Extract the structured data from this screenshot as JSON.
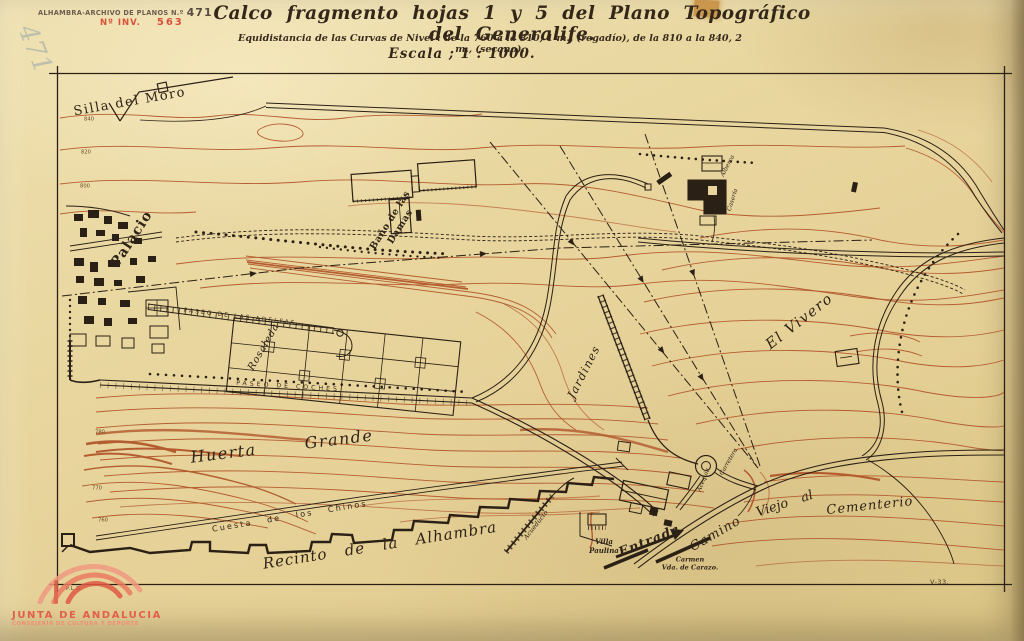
{
  "archive": {
    "stamp_prefix": "ALHAMBRA-ARCHIVO DE PLANOS N.º",
    "stamp_number": "471",
    "inv_label": "Nº INV.",
    "inv_number": "563",
    "pencil_number": "471"
  },
  "title": {
    "main": "Calco fragmento hojas 1 y 5 del Plano Topográfico del Generalife.",
    "subtitle": "Equidistancia de las Curvas de Nivel : de la 760 a la 810, 1 m., (regadío), de la 810 a la 840, 2 m., (secano).",
    "scale": "Escala ; 1 : 1000."
  },
  "map_labels": {
    "silla_del_moro": "Silla del Moro",
    "palacio": "Palacio",
    "bano_de_las": "Baño de las",
    "damas": "Damas",
    "paseo_adelfas": "Paseo de las Adelfas",
    "rosaleda": "Rosaleda",
    "paseo_coches": "Paseo de Coches",
    "huerta_grande": "Huerta  Grande",
    "jardines": "Jardines",
    "el_vivero": "El Vivero",
    "alberca": "Alberca",
    "caseria": "Casería",
    "cuesta_chinos": "Cuesta  de  los  Chinos",
    "recinto_alhambra": "Recinto  de  la  Alhambra",
    "acueducto": "Acueducto",
    "acequia": "Acequia",
    "carretera": "Carretera",
    "villa": "Villa",
    "paulina": "Paulina",
    "entrada": "Entrada",
    "carmen": "Carmen",
    "vda_carazo": "Vda. de Carazo.",
    "camino": "Camino",
    "viejo_al": "Viejo  al",
    "cementerio": "Cementerio"
  },
  "contour_labels": [
    "840",
    "820",
    "800",
    "780",
    "770",
    "760"
  ],
  "footer": {
    "corner_left": "P.L.D.",
    "plate_mark": "V-33."
  },
  "logo": {
    "line1": "JUNTA DE ANDALUCIA",
    "line2": "CONSEJERÍA DE CULTURA Y DEPORTE"
  },
  "colors": {
    "paper": "#e9d7a0",
    "contour_ink": "#b2572b",
    "drawing_ink": "#2b2015",
    "stamp_red": "#d8503a",
    "logo_red": "#e2604a"
  }
}
